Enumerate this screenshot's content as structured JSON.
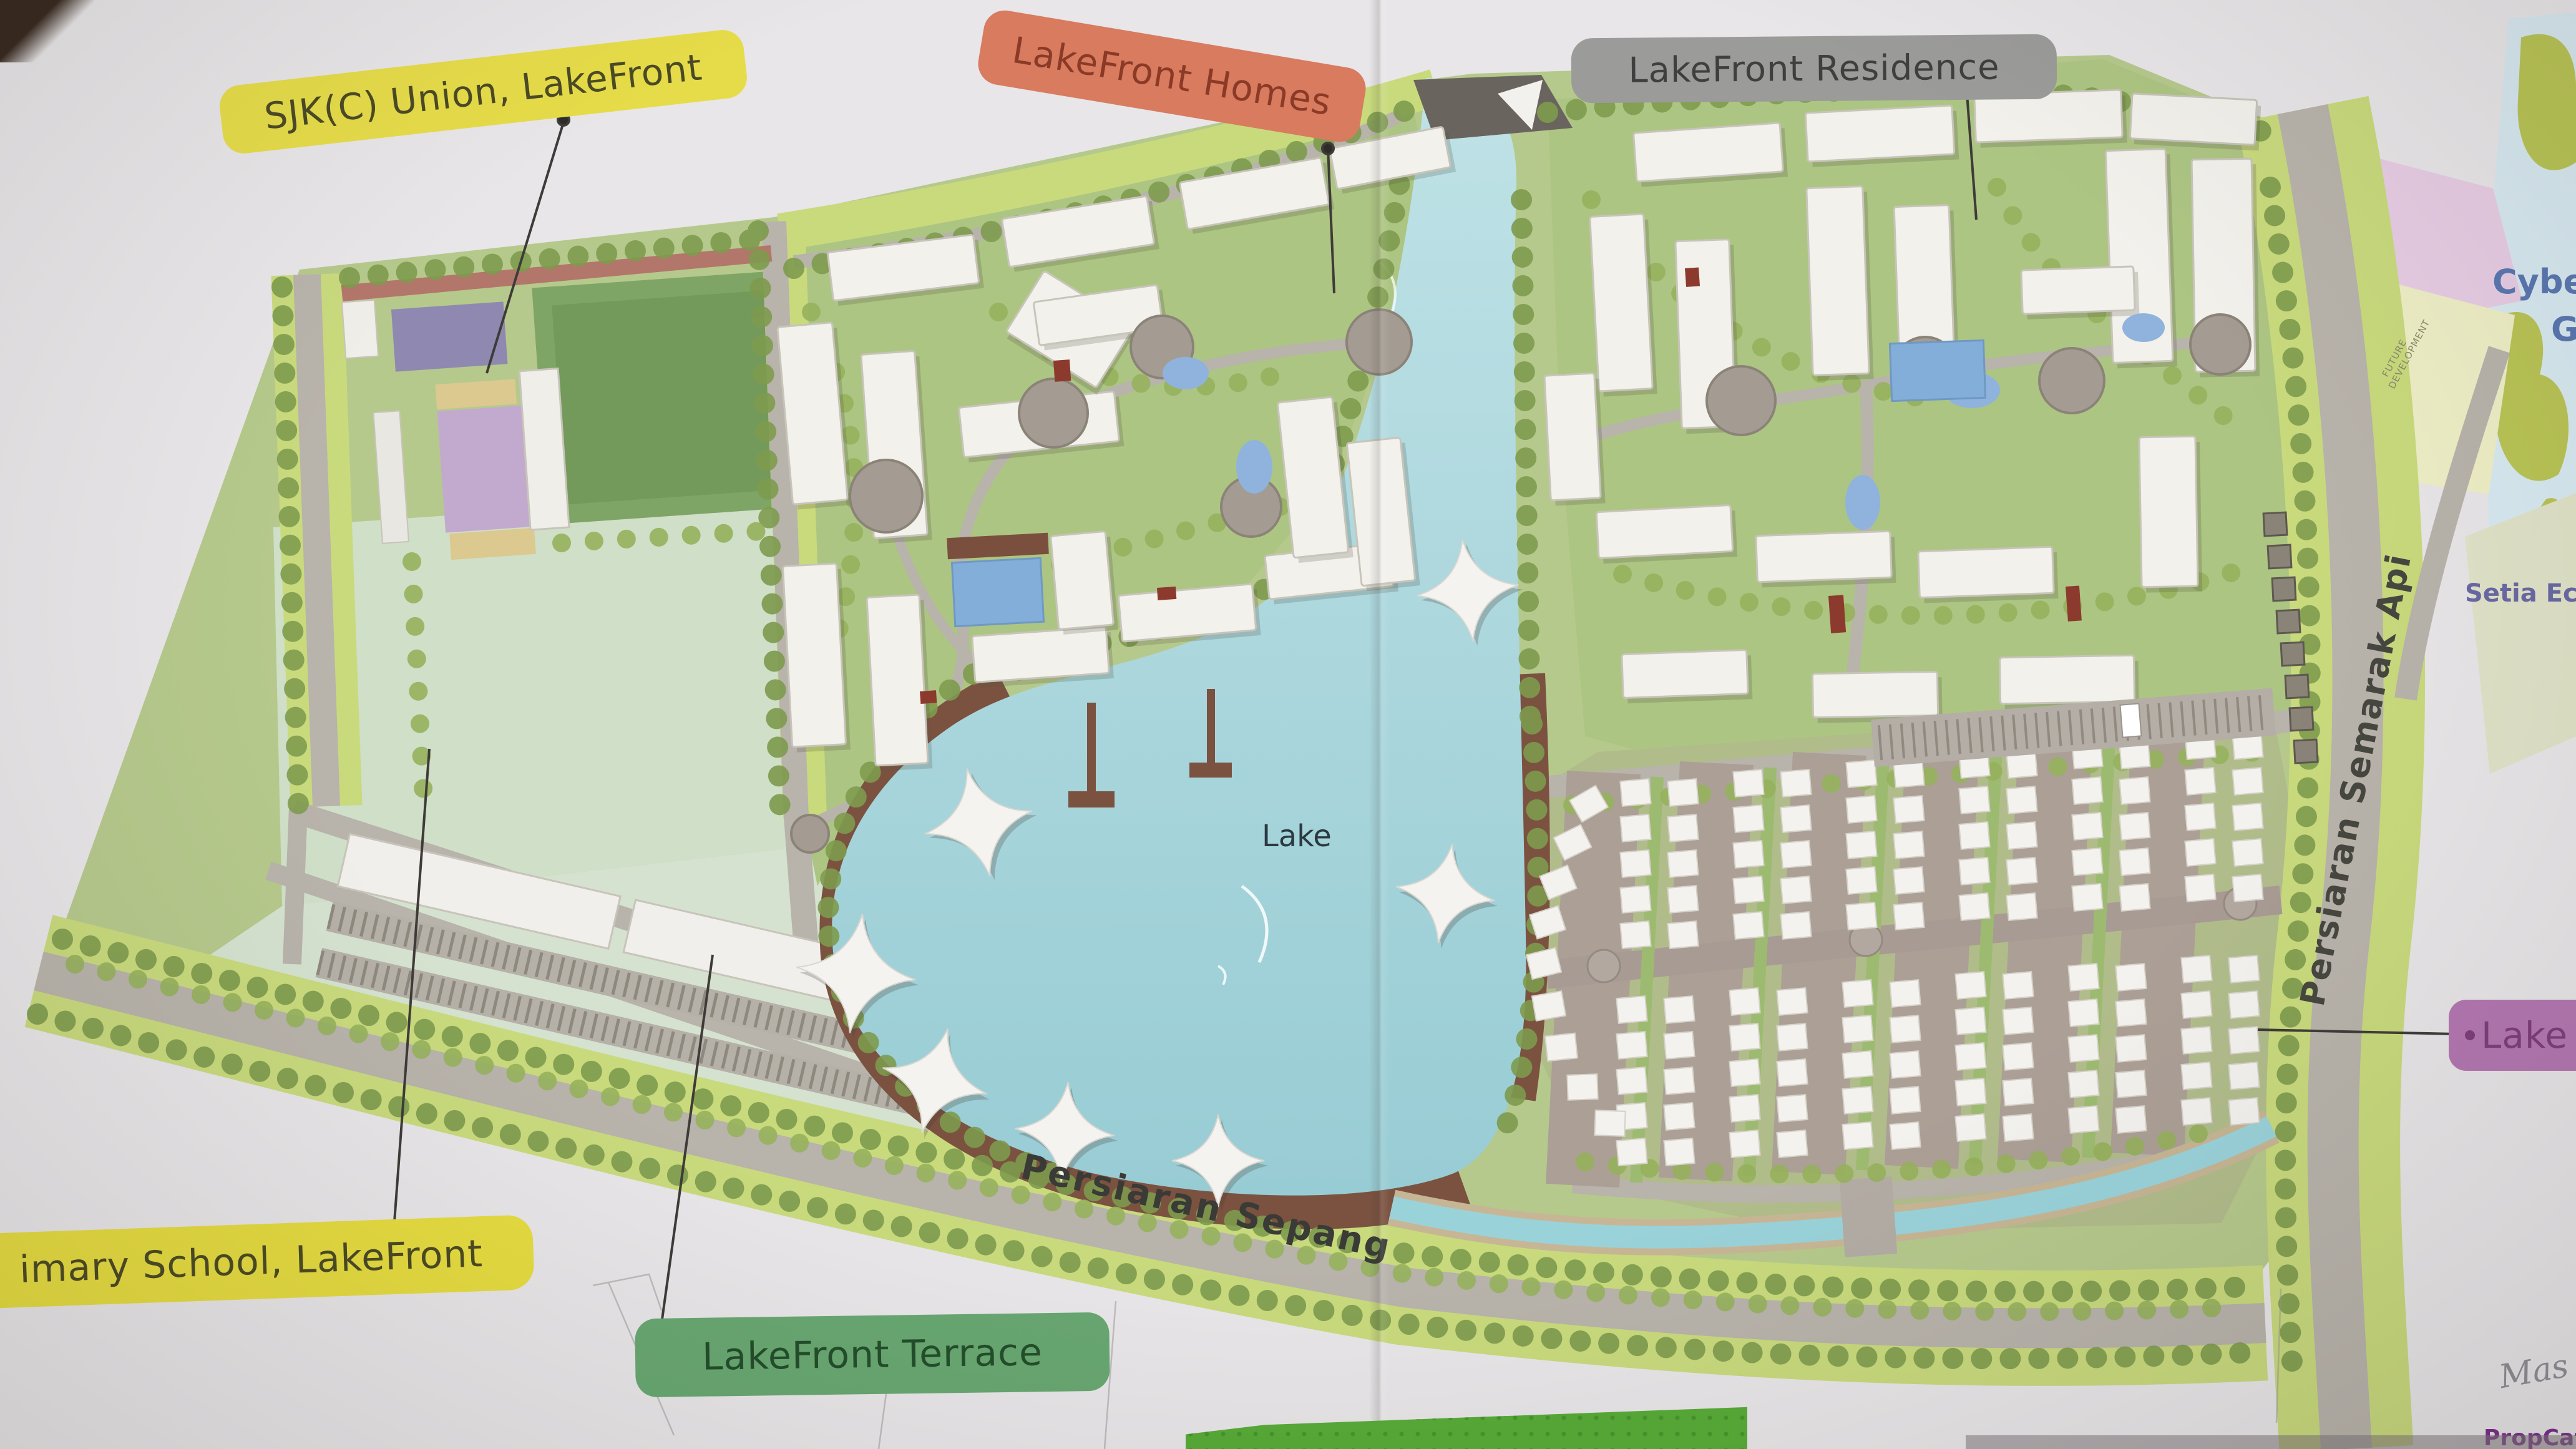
{
  "callout_labels": {
    "school_top": {
      "text": "SJK(C) Union, LakeFront",
      "bg": "#e6dc49",
      "fg": "#4b4a26"
    },
    "homes": {
      "text": "LakeFront Homes",
      "bg": "#d87b5e",
      "fg": "#8a3a26"
    },
    "residence": {
      "text": "LakeFront Residence",
      "bg": "#9b9b99",
      "fg": "#3f3f3f"
    },
    "school_bottom": {
      "text": "imary School, LakeFront",
      "bg": "#e6dc40",
      "fg": "#4b4a24"
    },
    "terrace": {
      "text": "LakeFront Terrace",
      "bg": "#68a771",
      "fg": "#234d2b"
    },
    "lake_right": {
      "text": "Lake",
      "bg": "#b377b1",
      "fg": "#7e3d7a"
    }
  },
  "map_labels": {
    "lake": "Lake",
    "road_bottom": "Persiaran Sepang",
    "road_right": "Persiaran Semarak Api",
    "neighbor_top": "Cyber",
    "neighbor_top2": "G",
    "neighbor_right": "Setia Ec",
    "future_development": "FUTURE DEVELOPMENT"
  },
  "photo": {
    "watermark": "PropCafe.Net",
    "handwriting": "Mas"
  },
  "colors": {
    "label_yellow": "#e6dc49",
    "label_orange": "#d87b5e",
    "label_gray": "#9b9b99",
    "label_green": "#68a771",
    "label_purple": "#b377b1",
    "lake_water": "#a9d4db",
    "promenade_brown": "#7b5240",
    "land_green": "#b6c98c",
    "road_gray": "#b8b3ab",
    "watermark_purple": "#7b2d8c"
  }
}
